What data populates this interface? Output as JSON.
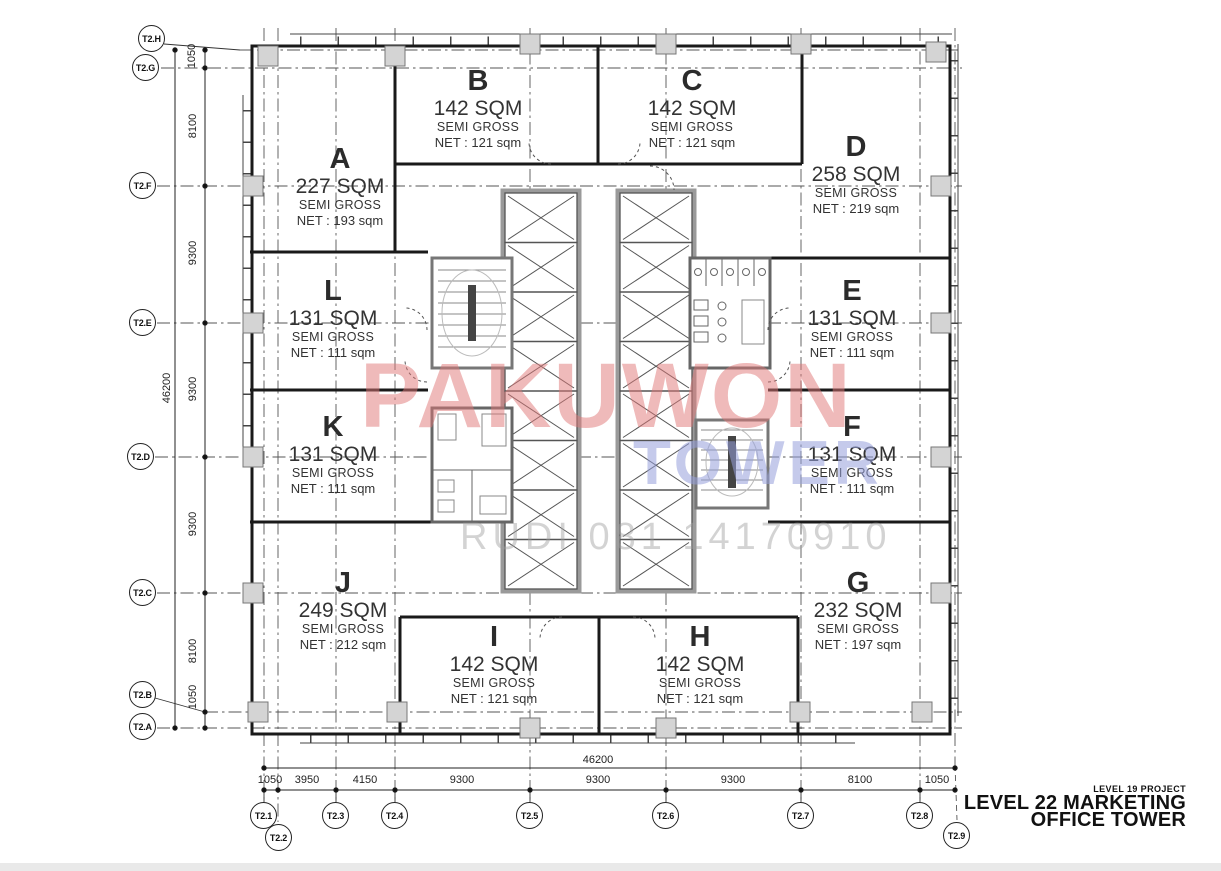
{
  "page": {
    "background": "#ffffff",
    "bottom_bar_color": "#e9e9e9"
  },
  "title_block": {
    "small": "LEVEL 19 PROJECT",
    "line1": "LEVEL 22 MARKETING",
    "line2": "OFFICE TOWER"
  },
  "watermark": {
    "name": "PAKUWON",
    "tower": "TOWER",
    "contact": "RUDI 081 14170910",
    "name_color": "#e07878",
    "tower_color": "#96a0dc",
    "contact_color": "#a0a0a0"
  },
  "units": [
    {
      "letter": "A",
      "area": "227 SQM",
      "gross": "SEMI GROSS",
      "net": "NET : 193 sqm"
    },
    {
      "letter": "B",
      "area": "142 SQM",
      "gross": "SEMI GROSS",
      "net": "NET : 121 sqm"
    },
    {
      "letter": "C",
      "area": "142 SQM",
      "gross": "SEMI GROSS",
      "net": "NET : 121 sqm"
    },
    {
      "letter": "D",
      "area": "258 SQM",
      "gross": "SEMI GROSS",
      "net": "NET : 219 sqm"
    },
    {
      "letter": "E",
      "area": "131 SQM",
      "gross": "SEMI GROSS",
      "net": "NET : 111 sqm"
    },
    {
      "letter": "F",
      "area": "131 SQM",
      "gross": "SEMI GROSS",
      "net": "NET : 111 sqm"
    },
    {
      "letter": "G",
      "area": "232 SQM",
      "gross": "SEMI GROSS",
      "net": "NET : 197 sqm"
    },
    {
      "letter": "H",
      "area": "142 SQM",
      "gross": "SEMI GROSS",
      "net": "NET : 121 sqm"
    },
    {
      "letter": "I",
      "area": "142 SQM",
      "gross": "SEMI GROSS",
      "net": "NET : 121 sqm"
    },
    {
      "letter": "J",
      "area": "249 SQM",
      "gross": "SEMI GROSS",
      "net": "NET : 212 sqm"
    },
    {
      "letter": "K",
      "area": "131 SQM",
      "gross": "SEMI GROSS",
      "net": "NET : 111 sqm"
    },
    {
      "letter": "L",
      "area": "131 SQM",
      "gross": "SEMI GROSS",
      "net": "NET : 111 sqm"
    }
  ],
  "grid": {
    "left": [
      {
        "label": "T2.H"
      },
      {
        "label": "T2.G"
      },
      {
        "label": "T2.F"
      },
      {
        "label": "T2.E"
      },
      {
        "label": "T2.D"
      },
      {
        "label": "T2.C"
      },
      {
        "label": "T2.B"
      },
      {
        "label": "T2.A"
      }
    ],
    "bottom": [
      {
        "label": "T2.1"
      },
      {
        "label": "T2.2"
      },
      {
        "label": "T2.3"
      },
      {
        "label": "T2.4"
      },
      {
        "label": "T2.5"
      },
      {
        "label": "T2.6"
      },
      {
        "label": "T2.7"
      },
      {
        "label": "T2.8"
      },
      {
        "label": "T2.9"
      }
    ]
  },
  "dimensions": {
    "left_total": "46200",
    "left_segments": [
      "1050",
      "8100",
      "9300",
      "9300",
      "9300",
      "8100",
      "1050"
    ],
    "bottom_total": "46200",
    "bottom_segments": [
      "1050",
      "3950",
      "4150",
      "9300",
      "9300",
      "9300",
      "8100",
      "1050"
    ]
  }
}
